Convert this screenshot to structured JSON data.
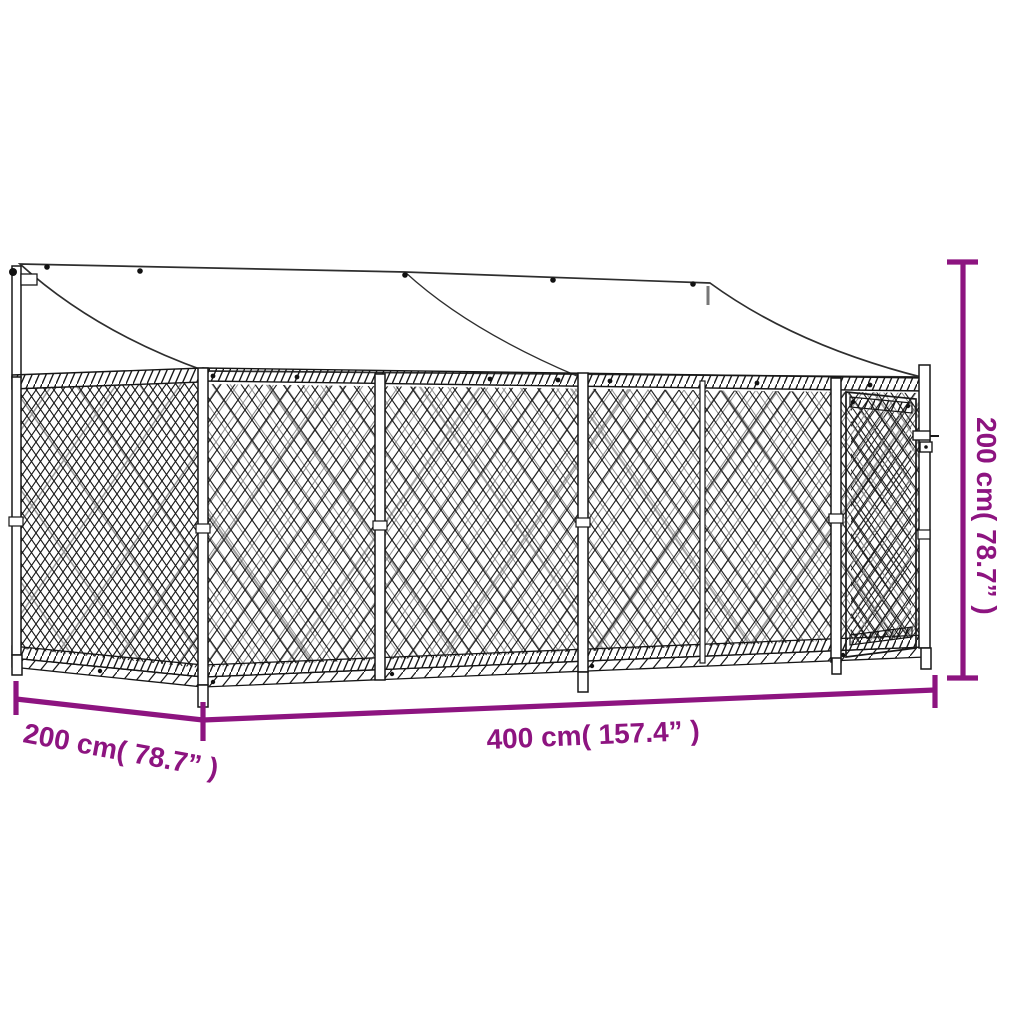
{
  "diagram": {
    "subject": "outdoor-dog-kennel-with-roof-and-door",
    "background_color": "#ffffff",
    "line_color": "#1a1a1a",
    "accent_color": "#8d1480"
  },
  "dimensions": {
    "depth": {
      "label": "200 cm( 78.7”  )",
      "value_cm": 200,
      "value_in": 78.7
    },
    "width": {
      "label": "400 cm( 157.4”  )",
      "value_cm": 400,
      "value_in": 157.4
    },
    "height": {
      "label": "200 cm( 78.7”  )",
      "value_cm": 200,
      "value_in": 78.7
    }
  }
}
